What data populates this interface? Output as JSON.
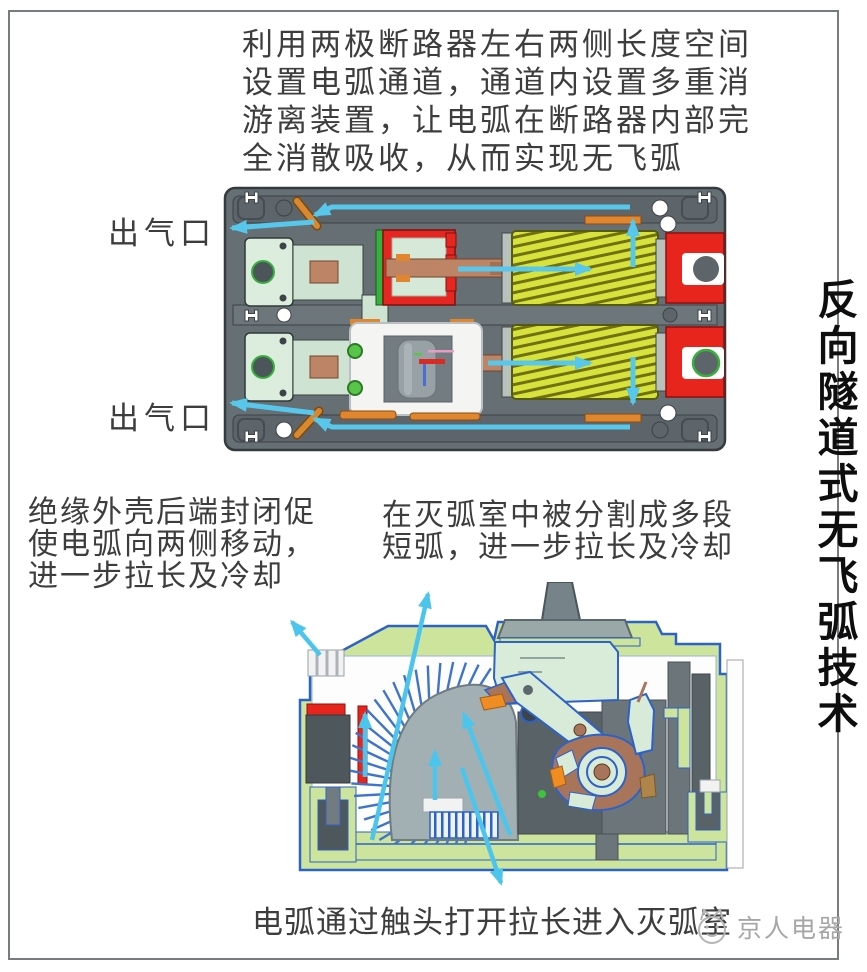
{
  "title": {
    "vertical": "反向隧道式无飞弧技术"
  },
  "intro": {
    "text": "利用两极断路器左右两侧长度空间\n设置电弧通道，通道内设置多重消\n游离装置，让电弧在断路器内部完\n全消散吸收，从而实现无飞弧"
  },
  "labels": {
    "outlet_top": "出气口",
    "outlet_bottom": "出气口",
    "left_note": "绝缘外壳后端封闭促\n使电弧向两侧移动，\n进一步拉长及冷却",
    "right_note": "在灭弧室中被分割成多段\n短弧，进一步拉长及冷却",
    "caption": "电弧通过触头打开拉长进入灭弧室"
  },
  "watermark": {
    "brand": "京人电器"
  },
  "colors": {
    "arrow_cyan": "#57c8ec",
    "housing_gray": "#666f74",
    "terminal_red": "#e8251d",
    "arc_chute_yellow": "#d8e23c",
    "contact_copper": "#bd8465",
    "orange": "#e0862e",
    "mint": "#dcecdd",
    "green_strip": "#36b23c",
    "shell_lime": "#cde49d",
    "outline_blue": "#2d62c8"
  }
}
